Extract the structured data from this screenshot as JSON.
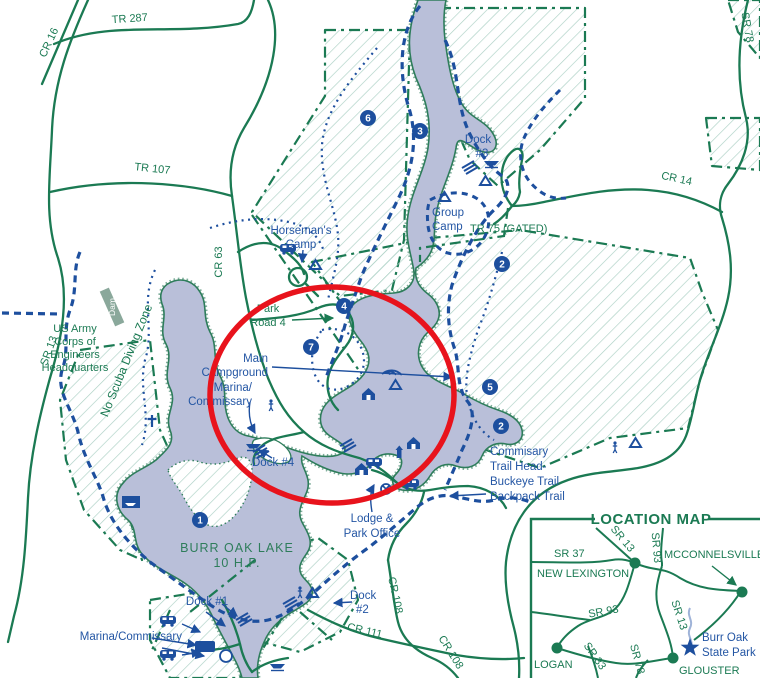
{
  "colors": {
    "road_green": "#1b7a53",
    "trail_blue": "#1d4f9e",
    "label_blue": "#2456a4",
    "lake_fill": "#b9bfd9",
    "hatch_green": "#abd0c4",
    "highlight_red": "#e8131c"
  },
  "main_map": {
    "road_labels": {
      "cr16": "CR 16",
      "tr287": "TR 287",
      "tr107": "TR 107",
      "sr78": "SR 78",
      "cr14": "CR 14",
      "tr75": "TR 75 (GATED)",
      "cr63": "CR 63",
      "sr13": "SR 13",
      "park_road_4a": "Park",
      "park_road_4b": "Road 4",
      "cr108a": "CR 108",
      "cr108b": "CR 108",
      "cr111": "CR 111"
    },
    "poi_labels": {
      "horsemans_camp": [
        "Horseman's",
        "Camp"
      ],
      "group_camp": [
        "Group",
        "Camp"
      ],
      "dock3": [
        "Dock",
        "#3"
      ],
      "main_campground": [
        "Main",
        "Campground"
      ],
      "marina_mid": [
        "Marina/",
        "Commissary"
      ],
      "dock4": "Dock #4",
      "commissary_trail": [
        "Commisary",
        "Trail Head-",
        "Buckeye Trail",
        "Backpack Trail"
      ],
      "lodge": [
        "Lodge &",
        "Park Office"
      ],
      "dock1": "Dock #1",
      "dock2": [
        "Dock",
        "#2"
      ],
      "marina_bottom": "Marina/Commissary",
      "us_army": [
        "US Army",
        "Corps of",
        "Engineers",
        "Headquarters"
      ],
      "no_scuba": "No Scuba Diving Zone",
      "dam": "Dam",
      "lake_name": [
        "BURR OAK LAKE",
        "10 H.P."
      ]
    },
    "markers": {
      "m1": "1",
      "m2a": "2",
      "m2b": "2",
      "m3": "3",
      "m4": "4",
      "m5": "5",
      "m6": "6",
      "m7": "7"
    }
  },
  "inset": {
    "title": "LOCATION MAP",
    "towns": {
      "new_lexington": "NEW LEXINGTON",
      "mcconnelsville": "MCCONNELSVILLE",
      "logan": "LOGAN",
      "glouster": "GLOUSTER"
    },
    "roads": {
      "sr37": "SR 37",
      "sr13a": "SR 13",
      "sr93a": "SR 93",
      "sr93b": "SR 93",
      "sr13b": "SR 13",
      "sr78": "SR 78",
      "sr33": "SR 33"
    },
    "park": [
      "Burr Oak",
      "State Park"
    ]
  }
}
